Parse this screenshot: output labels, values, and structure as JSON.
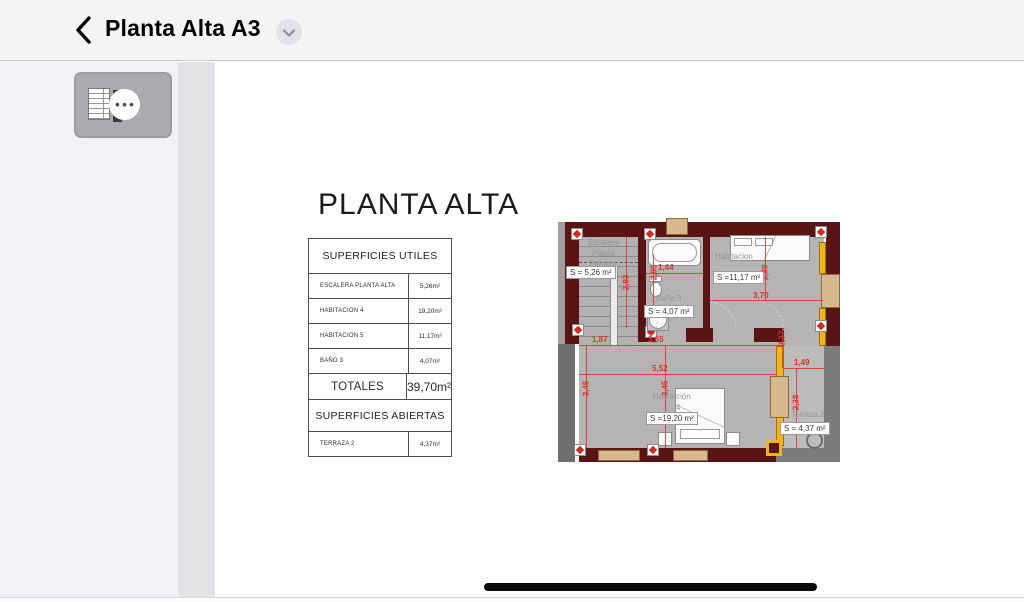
{
  "header": {
    "title": "Planta Alta A3"
  },
  "sidebar": {
    "thumbnail": {
      "ellipsis": "•••"
    }
  },
  "page": {
    "title": "PLANTA ALTA",
    "table": {
      "header1": "SUPERFICIES UTILES",
      "rows": [
        {
          "label": "ESCALERA PLANTA ALTA",
          "value": "5,26m²"
        },
        {
          "label": "HABITACION 4",
          "value": "19,20m²"
        },
        {
          "label": "HABITACION 5",
          "value": "11,17m²"
        },
        {
          "label": "BAÑO 3",
          "value": "4,07m²"
        }
      ],
      "totals": {
        "label": "TOTALES",
        "value": "39,70m²"
      },
      "header2": "SUPERFICIES ABIERTAS",
      "open_rows": [
        {
          "label": "TERRAZA 2",
          "value": "4,37m²"
        }
      ]
    },
    "plan": {
      "rooms": {
        "escalera": {
          "lines": [
            "Escalera",
            "Planta",
            "Primera"
          ],
          "area": "S = 5,26 m²"
        },
        "bano": {
          "name": "Baño 3",
          "area": "S = 4,07 m²"
        },
        "hab5": {
          "name": "Habitacion",
          "number": "5",
          "area": "S =11,17 m²"
        },
        "hab4": {
          "name": "Habitación",
          "number": "4",
          "area": "S =19,20 m²"
        },
        "terraza": {
          "name": "Terraza 2",
          "area": "S = 4,37 m²"
        }
      },
      "dims": {
        "d144": "1,44",
        "d293": "2,93",
        "d205": "2,05",
        "d370": "3,70",
        "d288": "2,88",
        "d187": "1,87",
        "d365": "3,65",
        "d552": "5,52",
        "d345a": "3,45",
        "d345b": "3,45",
        "d149": "1,49",
        "d238": "2,38",
        "d237": "2,37"
      }
    }
  },
  "colors": {
    "wall_maroon": "#5a1414",
    "dimension_red": "#d8362a",
    "window_yellow": "#f0b41f",
    "window_tan": "#d8b88e",
    "floor_gray": "#b5b3b3",
    "navbar_bg": "#f4f4f5",
    "sidebar_bg": "#f2f2f6"
  }
}
